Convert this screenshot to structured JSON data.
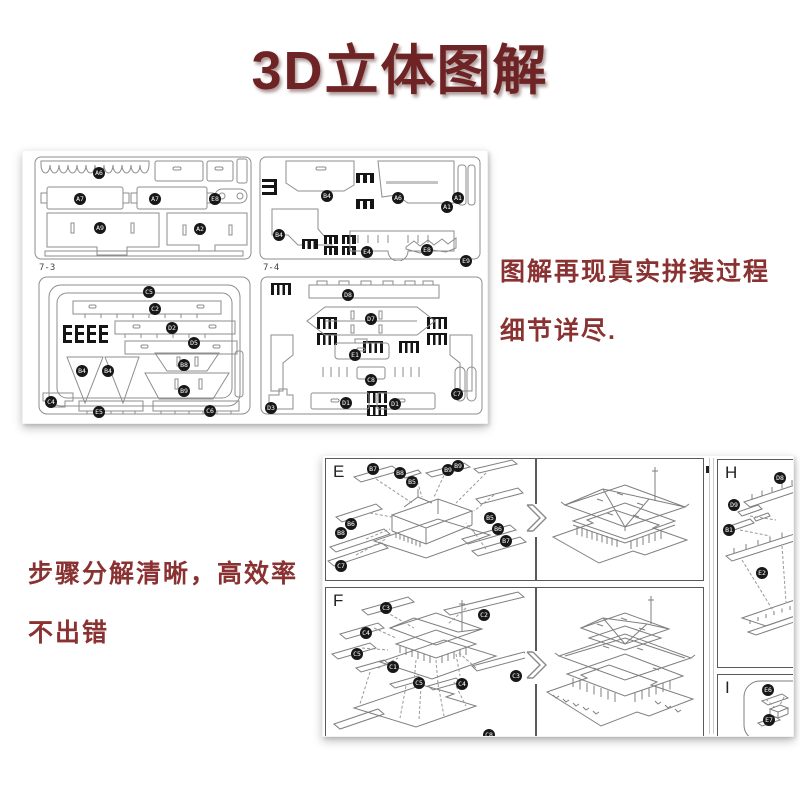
{
  "title": "3D立体图解",
  "colors": {
    "accent": "#6e2424",
    "caption": "#8a3232",
    "chip_bg": "#171717",
    "line_art": "#8b8b8b"
  },
  "captions": {
    "right": [
      "图解再现真实拼装过程",
      "细节详尽."
    ],
    "left": [
      "步骤分解清晰，高效率",
      "不出错"
    ]
  },
  "icons": {
    "between_panels": "chevron-right"
  },
  "sheets_image": {
    "sheets": [
      {
        "id": "",
        "piece_labels": [
          "A6",
          "A7",
          "A7",
          "E8",
          "A9",
          "A2"
        ]
      },
      {
        "id": "",
        "piece_labels": [
          "B4",
          "A6",
          "A1",
          "A1",
          "B4",
          "E4",
          "E8",
          "E9"
        ]
      },
      {
        "id": "7-3",
        "piece_labels": [
          "C5",
          "C2",
          "D2",
          "D5",
          "B4",
          "B4",
          "B8",
          "B9",
          "C4",
          "E5",
          "C6"
        ]
      },
      {
        "id": "7-4",
        "piece_labels": [
          "D8",
          "D7",
          "E1",
          "C8",
          "D1",
          "D1",
          "D3",
          "C7"
        ]
      }
    ]
  },
  "assembly_image": {
    "panels": [
      {
        "letter": "E",
        "piece_labels": [
          "B7",
          "B8",
          "B5",
          "B9",
          "B9",
          "B6",
          "B8",
          "B5",
          "B6",
          "B7",
          "C7"
        ]
      },
      {
        "letter": "F",
        "piece_labels": [
          "C3",
          "C2",
          "C4",
          "C5",
          "C1",
          "C5",
          "C4",
          "C3",
          "C8"
        ]
      },
      {
        "letter": "H",
        "piece_labels": [
          "D8",
          "D9",
          "B1",
          "E2"
        ]
      },
      {
        "letter": "I",
        "piece_labels": [
          "E6",
          "E7"
        ]
      }
    ]
  }
}
